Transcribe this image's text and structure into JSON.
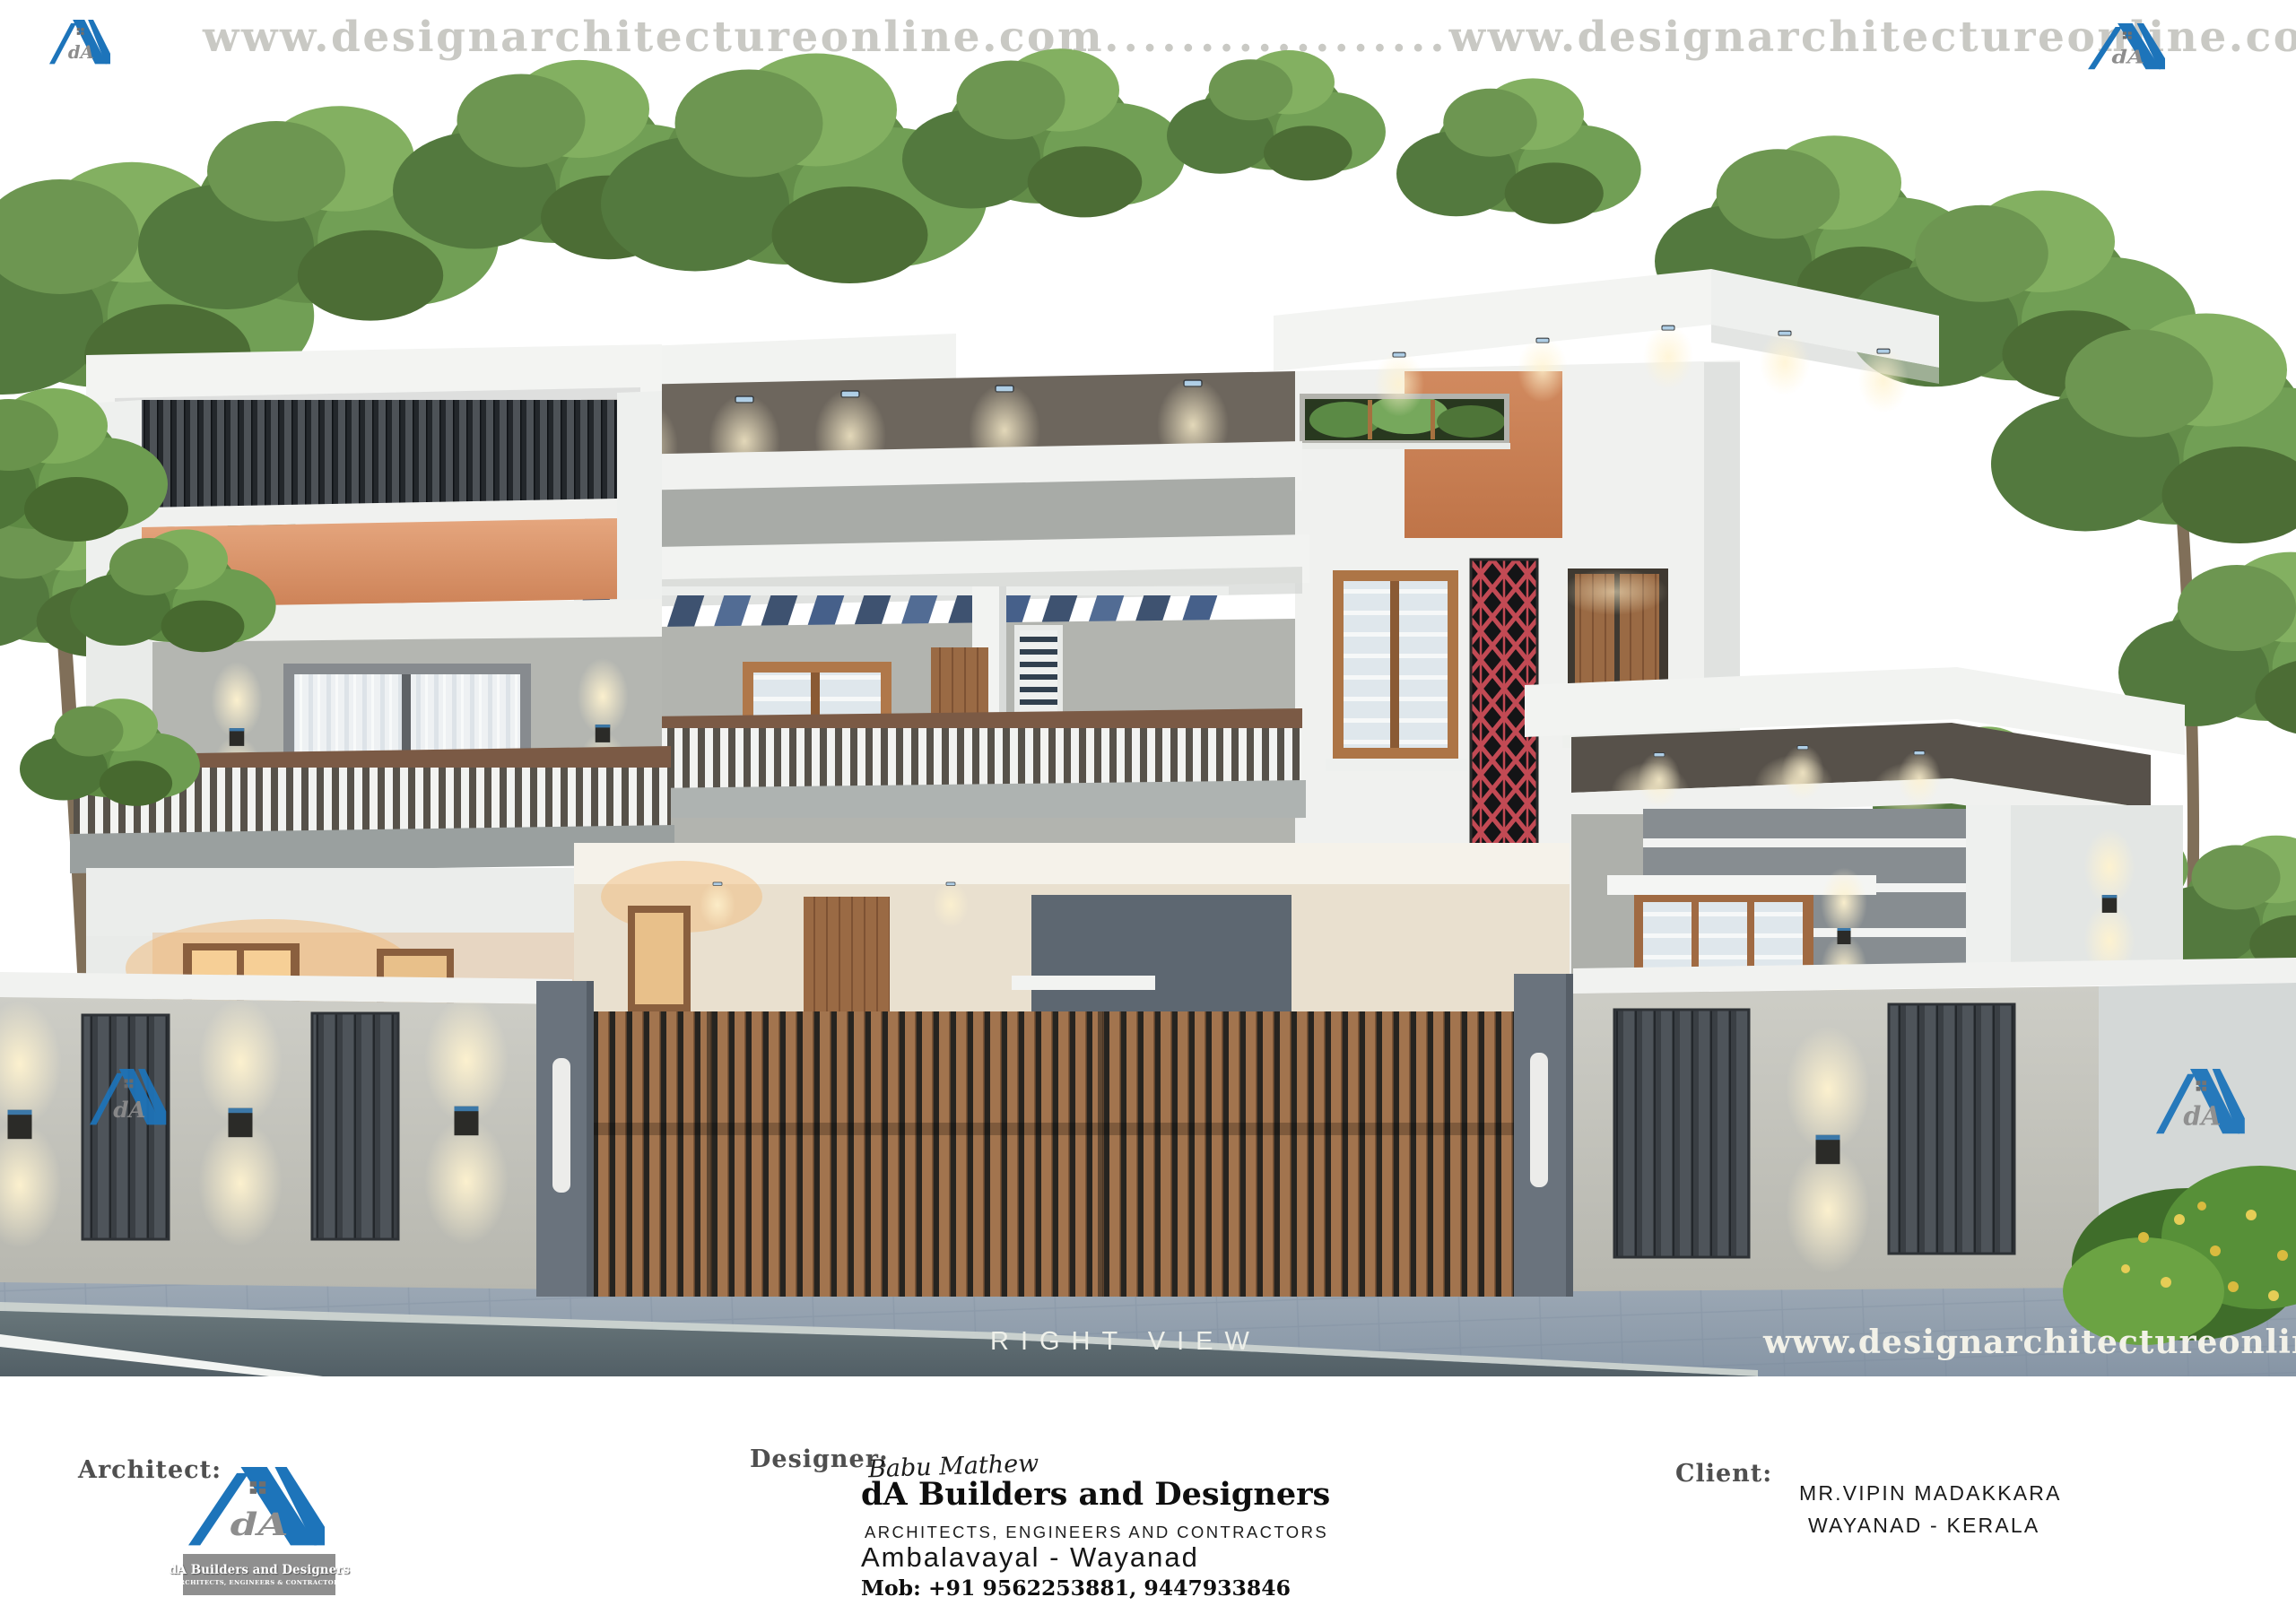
{
  "header": {
    "url_left": "www.designarchitectureonline.com",
    "separator_dots": "..................",
    "url_right": "www.designarchitectureonline.com"
  },
  "render": {
    "view_label": "RIGHT VIEW",
    "watermark_url": "www.designarchitectureonline.com"
  },
  "brand": {
    "monogram": "dA",
    "firm_name": "dA Builders and Designers",
    "logo_tagline": "ARCHITECTS, ENGINEERS & CONTRACTORS"
  },
  "footer": {
    "architect_label": "Architect:",
    "designer_label": "Designer:",
    "client_label": "Client:",
    "designer": {
      "signature": "Babu Mathew",
      "firm": "dA Builders and Designers",
      "tagline": "ARCHITECTS, ENGINEERS AND CONTRACTORS",
      "location": "Ambalavayal - Wayanad",
      "mobile": "Mob: +91 9562253881, 9447933846"
    },
    "client": {
      "name": "MR.VIPIN MADAKKARA",
      "location": "WAYANAD - KERALA"
    }
  },
  "colors": {
    "logo_blue": "#1d74ba",
    "header_text_gray": "#c9c9c4",
    "accent_orange": "#d9946b",
    "jali_red": "#c24a54"
  }
}
